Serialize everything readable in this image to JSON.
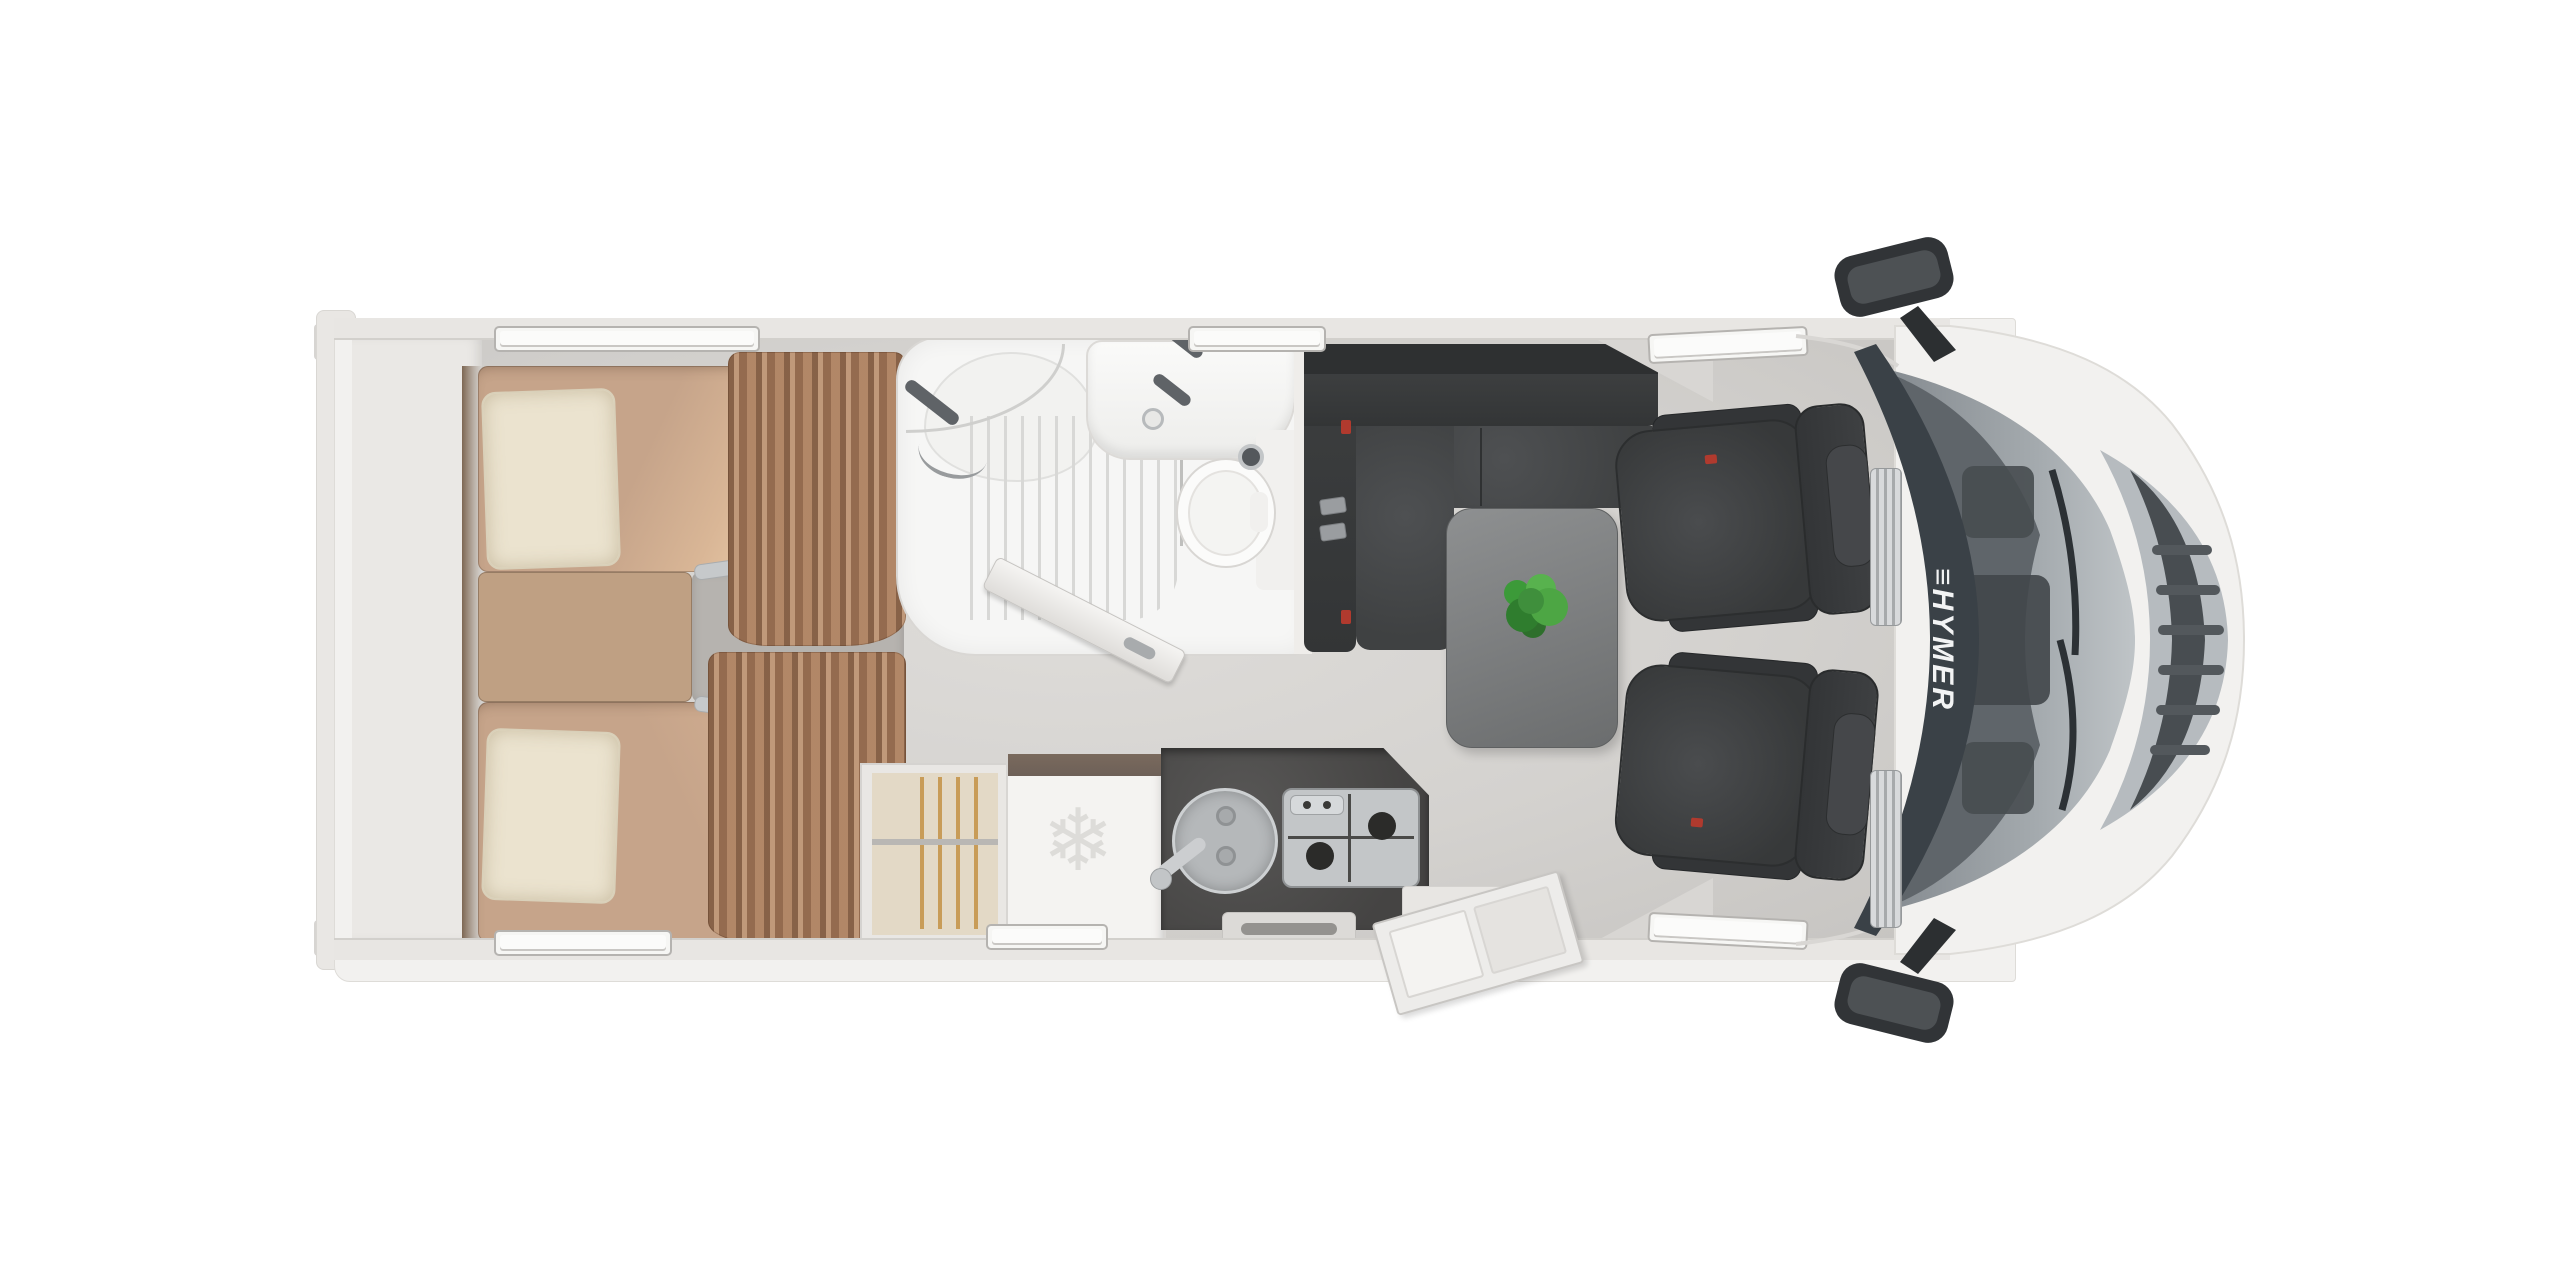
{
  "brand": {
    "windshield_label": "≡HYMER"
  },
  "icons": {
    "fridge_snowflake": "❄"
  },
  "colors": {
    "background": "#ffffff",
    "body": "#f2f1ef",
    "wall": "#e8e6e3",
    "floor": "#d4d2cf",
    "mattress": "#c6a48a",
    "mattress_highlight": "#ecceac",
    "pillow": "#ebe3cf",
    "curtain": "#a87d5e",
    "sofa": "#3a3c3d",
    "table": "#7d7f80",
    "chair": "#3e4041",
    "kitchen_counter": "#4f4e4c",
    "plant_green": "#3f8f3c",
    "windshield_band": "#3a4147",
    "hood_gray": "#a6acb0",
    "accent_red": "#b03a2e"
  },
  "areas": [
    {
      "name": "twin-beds-rear"
    },
    {
      "name": "wardrobe"
    },
    {
      "name": "refrigerator"
    },
    {
      "name": "kitchen-counter-sink-stove"
    },
    {
      "name": "bathroom-shower-basin-toilet"
    },
    {
      "name": "lounge-l-sofa-table"
    },
    {
      "name": "swivel-cab-seats"
    },
    {
      "name": "driver-cab"
    }
  ]
}
